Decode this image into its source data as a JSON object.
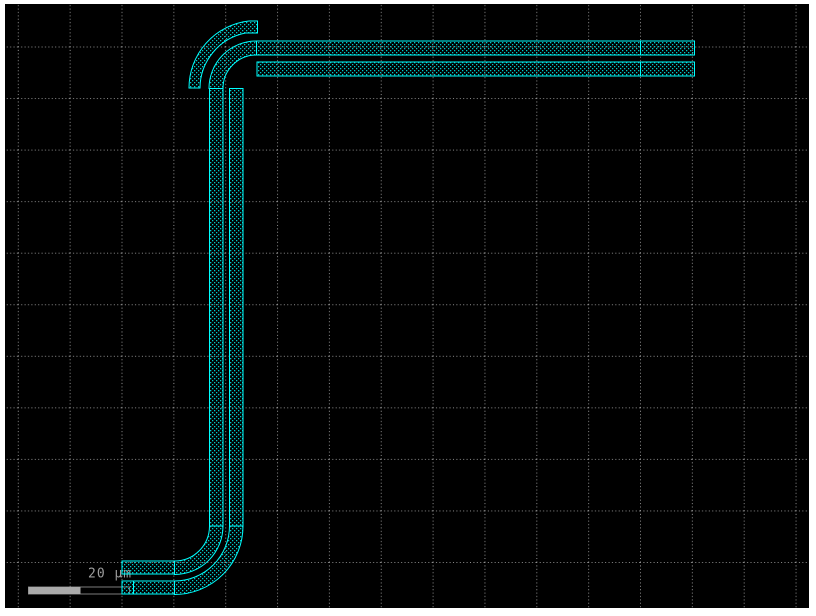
{
  "canvas": {
    "background": "#000000",
    "frame_color": "#ffffff",
    "grid": {
      "color": "#8f8f8f",
      "spacing_x": 51.85,
      "spacing_y": 51.55,
      "offset_x": 18.3,
      "offset_y": 47.0,
      "dot_length": 1,
      "dot_gap": 2.4
    }
  },
  "layer": {
    "outline_color": "#00ffff",
    "fill_dot_color": "#00c8c8"
  },
  "scale_bar": {
    "label": "20 μm",
    "text_color": "#9e9e9e",
    "bar_fill_color": "#aaaaaa",
    "bar_outline_color": "#7d7d7d"
  },
  "layout": {
    "segments": [
      {
        "name": "slot-a-bottom-straight",
        "kind": "rect",
        "x": 122,
        "y": 561,
        "w": 52.5,
        "h": 13
      },
      {
        "name": "slot-a-bottom-bend",
        "kind": "path",
        "d": "M 174.5 561 A 35 35 0 0 0 209.5 526 L 223 526 A 48.5 48.5 0 0 1 174.5 574.5 Z"
      },
      {
        "name": "slot-a-vertical-straight",
        "kind": "rect",
        "x": 209.5,
        "y": 88.5,
        "w": 13.5,
        "h": 437.5
      },
      {
        "name": "slot-a-top-bend",
        "kind": "path",
        "d": "M 223 88.5 A 33.5 33.5 0 0 1 256.5 55 L 256.5 41 A 47.5 47.5 0 0 0 209 88.5 Z"
      },
      {
        "name": "slot-a-top-straight-1",
        "kind": "rect",
        "x": 256.5,
        "y": 41,
        "w": 384,
        "h": 14
      },
      {
        "name": "slot-a-top-straight-2",
        "kind": "rect",
        "x": 640.5,
        "y": 41,
        "w": 54,
        "h": 14
      },
      {
        "name": "slot-b-bottom-end",
        "kind": "rect",
        "x": 122,
        "y": 581,
        "w": 11.5,
        "h": 13
      },
      {
        "name": "slot-b-bottom-straight",
        "kind": "rect",
        "x": 133.5,
        "y": 581,
        "w": 41,
        "h": 13
      },
      {
        "name": "slot-b-bottom-bend",
        "kind": "path",
        "d": "M 174.5 581 A 55 55 0 0 0 229.5 526 L 243 526 A 68.5 68.5 0 0 1 174.5 594.5 Z"
      },
      {
        "name": "slot-b-vertical-straight",
        "kind": "rect",
        "x": 229.5,
        "y": 88.5,
        "w": 13.5,
        "h": 437.5
      },
      {
        "name": "slot-b-top-straight-1",
        "kind": "rect",
        "x": 257,
        "y": 62,
        "w": 383.5,
        "h": 14
      },
      {
        "name": "slot-b-top-straight-2",
        "kind": "rect",
        "x": 640.5,
        "y": 62,
        "w": 54,
        "h": 14
      },
      {
        "name": "outer-bend-stub",
        "kind": "path",
        "d": "M 189 88 L 200 88 A 56.5 56.5 0 0 1 245.5 33 L 257.5 33 L 257.5 21 L 249 21 A 67.5 67.5 0 0 0 189 88 Z"
      }
    ]
  }
}
